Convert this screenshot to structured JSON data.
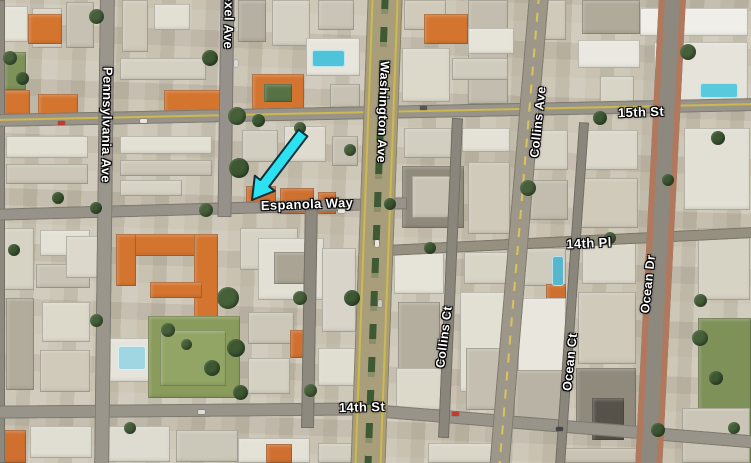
{
  "map": {
    "view_type": "satellite-aerial",
    "street_labels": [
      {
        "id": "drexel-ave",
        "text": "Drexel Ave",
        "x": 229,
        "y": 14,
        "rotate": 91,
        "size": 13
      },
      {
        "id": "pennsylvania-ave",
        "text": "Pennsylvania Ave",
        "x": 107,
        "y": 125,
        "rotate": 91,
        "size": 13
      },
      {
        "id": "washington-ave",
        "text": "Washington Ave",
        "x": 383,
        "y": 112,
        "rotate": 92,
        "size": 12.5
      },
      {
        "id": "collins-ave",
        "text": "Collins Ave",
        "x": 538,
        "y": 122,
        "rotate": -84,
        "size": 12.5
      },
      {
        "id": "fifteenth-st",
        "text": "15th St",
        "x": 641,
        "y": 112,
        "rotate": -2,
        "size": 13
      },
      {
        "id": "espanola-way",
        "text": "Espanola Way",
        "x": 307,
        "y": 204,
        "rotate": -2,
        "size": 13
      },
      {
        "id": "fourteenth-pl",
        "text": "14th Pl",
        "x": 589,
        "y": 243,
        "rotate": -2.5,
        "size": 13
      },
      {
        "id": "collins-ct",
        "text": "Collins Ct",
        "x": 444,
        "y": 337,
        "rotate": -83,
        "size": 12.5
      },
      {
        "id": "ocean-ct",
        "text": "Ocean Ct",
        "x": 570,
        "y": 362,
        "rotate": -84,
        "size": 12.5
      },
      {
        "id": "ocean-dr",
        "text": "Ocean Dr",
        "x": 648,
        "y": 284,
        "rotate": -84,
        "size": 12.5
      },
      {
        "id": "fourteenth-st",
        "text": "14th St",
        "x": 362,
        "y": 407,
        "rotate": -1.5,
        "size": 13
      }
    ],
    "annotation_arrow": {
      "fill": "#2be2f0",
      "outline": "#0e2e38",
      "from": {
        "x": 303,
        "y": 133
      },
      "to": {
        "x": 252,
        "y": 200
      },
      "shaft_width": 11,
      "head_width": 25,
      "head_length": 21
    },
    "label_style": {
      "color": "#ffffff",
      "halo": "#000000"
    }
  }
}
